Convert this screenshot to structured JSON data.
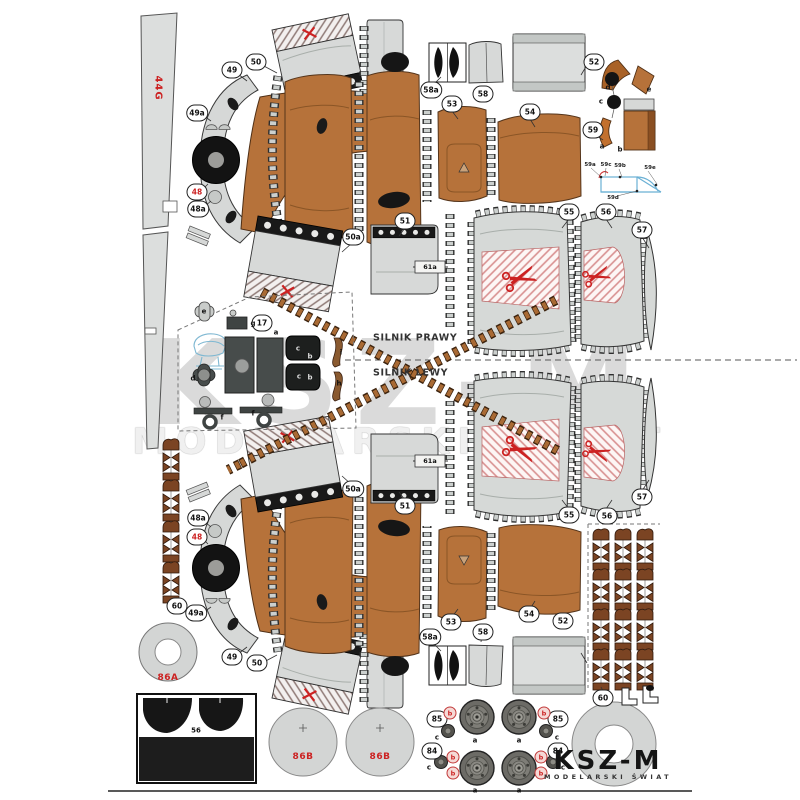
{
  "sheet_type": "paper-model-parts-sheet",
  "watermark": {
    "big": "KSZ-M",
    "sub": "MODELARSKI ŚWIAT"
  },
  "logo": {
    "name": "KSZ-M",
    "tagline": "MODELARSKI ŚWIAT"
  },
  "divider": {
    "right_engine": "SILNIK PRAWY",
    "left_engine": "SILNIK LEWY"
  },
  "strip": {
    "s44g": "44G"
  },
  "tags": {
    "t61a": "61a"
  },
  "reds": {
    "a86": "86A",
    "b86": "86B"
  },
  "badges": [
    {
      "t": "49"
    },
    {
      "t": "50"
    },
    {
      "t": "49a"
    },
    {
      "t": "48"
    },
    {
      "t": "48a"
    },
    {
      "t": "58a"
    },
    {
      "t": "58"
    },
    {
      "t": "52"
    },
    {
      "t": "53"
    },
    {
      "t": "54"
    },
    {
      "t": "59"
    },
    {
      "t": "51"
    },
    {
      "t": "50a"
    },
    {
      "t": "55"
    },
    {
      "t": "56"
    },
    {
      "t": "57"
    },
    {
      "t": "17"
    },
    {
      "t": "48a"
    },
    {
      "t": "48"
    },
    {
      "t": "49a"
    },
    {
      "t": "60"
    },
    {
      "t": "49"
    },
    {
      "t": "50"
    },
    {
      "t": "50a"
    },
    {
      "t": "51"
    },
    {
      "t": "55"
    },
    {
      "t": "56"
    },
    {
      "t": "57"
    },
    {
      "t": "53"
    },
    {
      "t": "58a"
    },
    {
      "t": "58"
    },
    {
      "t": "54"
    },
    {
      "t": "52"
    },
    {
      "t": "60"
    },
    {
      "t": "85"
    },
    {
      "t": "85"
    },
    {
      "t": "84"
    },
    {
      "t": "84"
    }
  ],
  "letters": [
    {
      "t": "a"
    },
    {
      "t": "b"
    },
    {
      "t": "c"
    },
    {
      "t": "d"
    },
    {
      "t": "e"
    },
    {
      "t": "e"
    },
    {
      "t": "g"
    },
    {
      "t": "a"
    },
    {
      "t": "d"
    },
    {
      "t": "c"
    },
    {
      "t": "b"
    },
    {
      "t": "c"
    },
    {
      "t": "b"
    },
    {
      "t": "i"
    },
    {
      "t": "h"
    },
    {
      "t": "f"
    },
    {
      "t": "f"
    },
    {
      "t": "a"
    },
    {
      "t": "a"
    },
    {
      "t": "a"
    },
    {
      "t": "a"
    },
    {
      "t": "c"
    },
    {
      "t": "c"
    },
    {
      "t": "c"
    },
    {
      "t": "c"
    },
    {
      "t": "56"
    }
  ],
  "bcircles": [
    {
      "t": "b"
    },
    {
      "t": "b"
    },
    {
      "t": "b"
    },
    {
      "t": "b"
    },
    {
      "t": "b"
    },
    {
      "t": "b"
    }
  ],
  "diagram59": {
    "labels": [
      {
        "t": "59a"
      },
      {
        "t": "59c"
      },
      {
        "t": "59b"
      },
      {
        "t": "59e"
      },
      {
        "t": "59d"
      }
    ]
  }
}
